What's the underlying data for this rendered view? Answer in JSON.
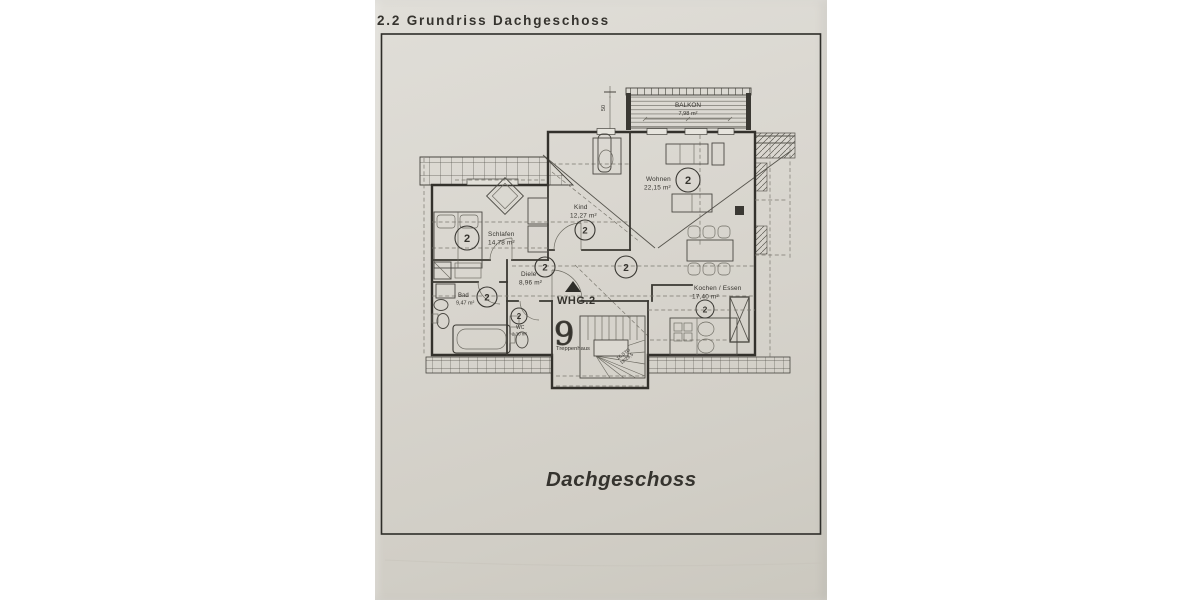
{
  "page": {
    "title": "2.2 Grundriss Dachgeschoss",
    "caption": "Dachgeschoss"
  },
  "plan": {
    "unit_badge": "2",
    "apartment_label": "WHG.2",
    "balcony": {
      "name": "BALKON",
      "area": "7,98 m²"
    },
    "rooms": [
      {
        "name": "Wohnen",
        "area": "22,15 m²"
      },
      {
        "name": "Kind",
        "area": "12,27 m²"
      },
      {
        "name": "Schlafen",
        "area": "14,78 m²"
      },
      {
        "name": "Diele",
        "area": "8,96 m²"
      },
      {
        "name": "Bad",
        "area": "9,47 m²"
      },
      {
        "name": "WC",
        "area": "2,30 m²"
      },
      {
        "name": "Kochen / Essen",
        "area": "17,40 m²"
      }
    ],
    "stair": {
      "label": "Treppenhaus",
      "glyph": "9",
      "note_line1": "16 STG",
      "note_line2": "18/26,5"
    },
    "dimensions": {
      "balcony_depth": "50"
    }
  }
}
